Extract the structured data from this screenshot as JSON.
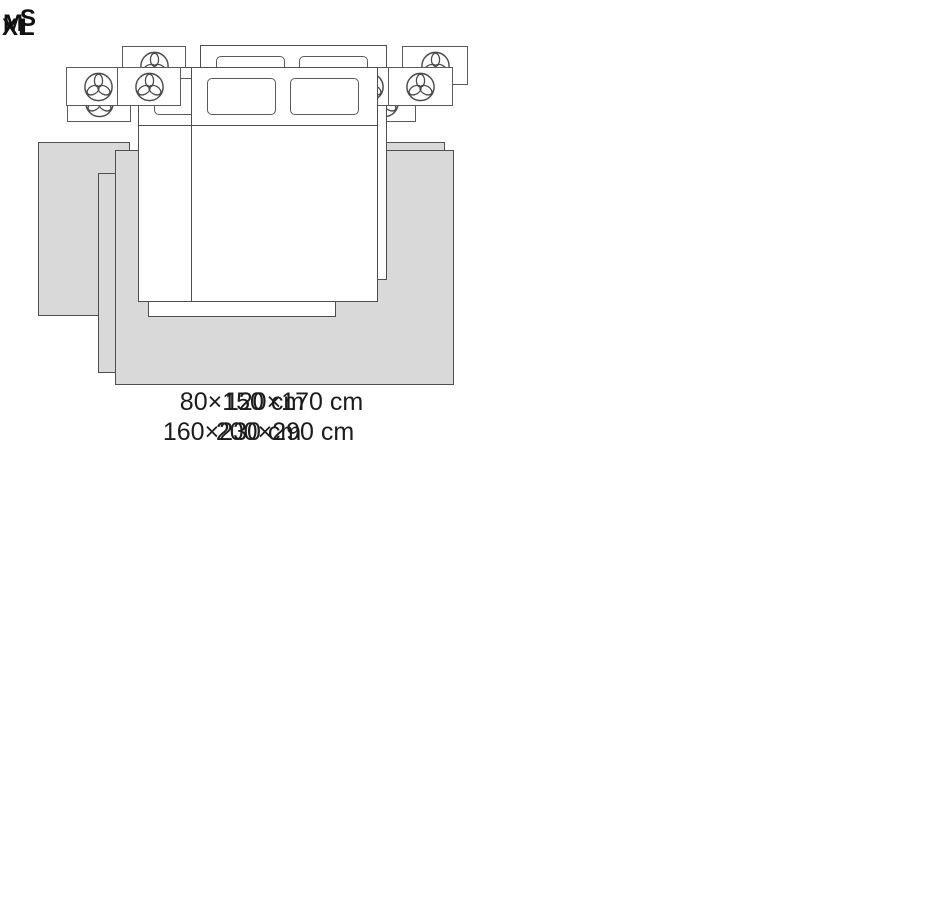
{
  "panels": [
    {
      "label": "S",
      "dimension": "80×150 cm",
      "layout_note": "two runner rugs, one on each side of the bed"
    },
    {
      "label": "M",
      "dimension": "120×170 cm",
      "layout_note": "rug under foot of bed, slightly wider than bed"
    },
    {
      "label": "L",
      "dimension": "160×230 cm",
      "layout_note": "rug under lower two-thirds of bed, extends past sides"
    },
    {
      "label": "XL",
      "dimension": "200×290 cm",
      "layout_note": "rug spans full width of nightstands, under lower bed"
    }
  ],
  "icons": {
    "nightstand": "plant-icon"
  },
  "colors": {
    "background": "#ffffff",
    "rug_fill": "#d9d9d9",
    "outline": "#4d4d4d",
    "text": "#1c1c1c"
  }
}
